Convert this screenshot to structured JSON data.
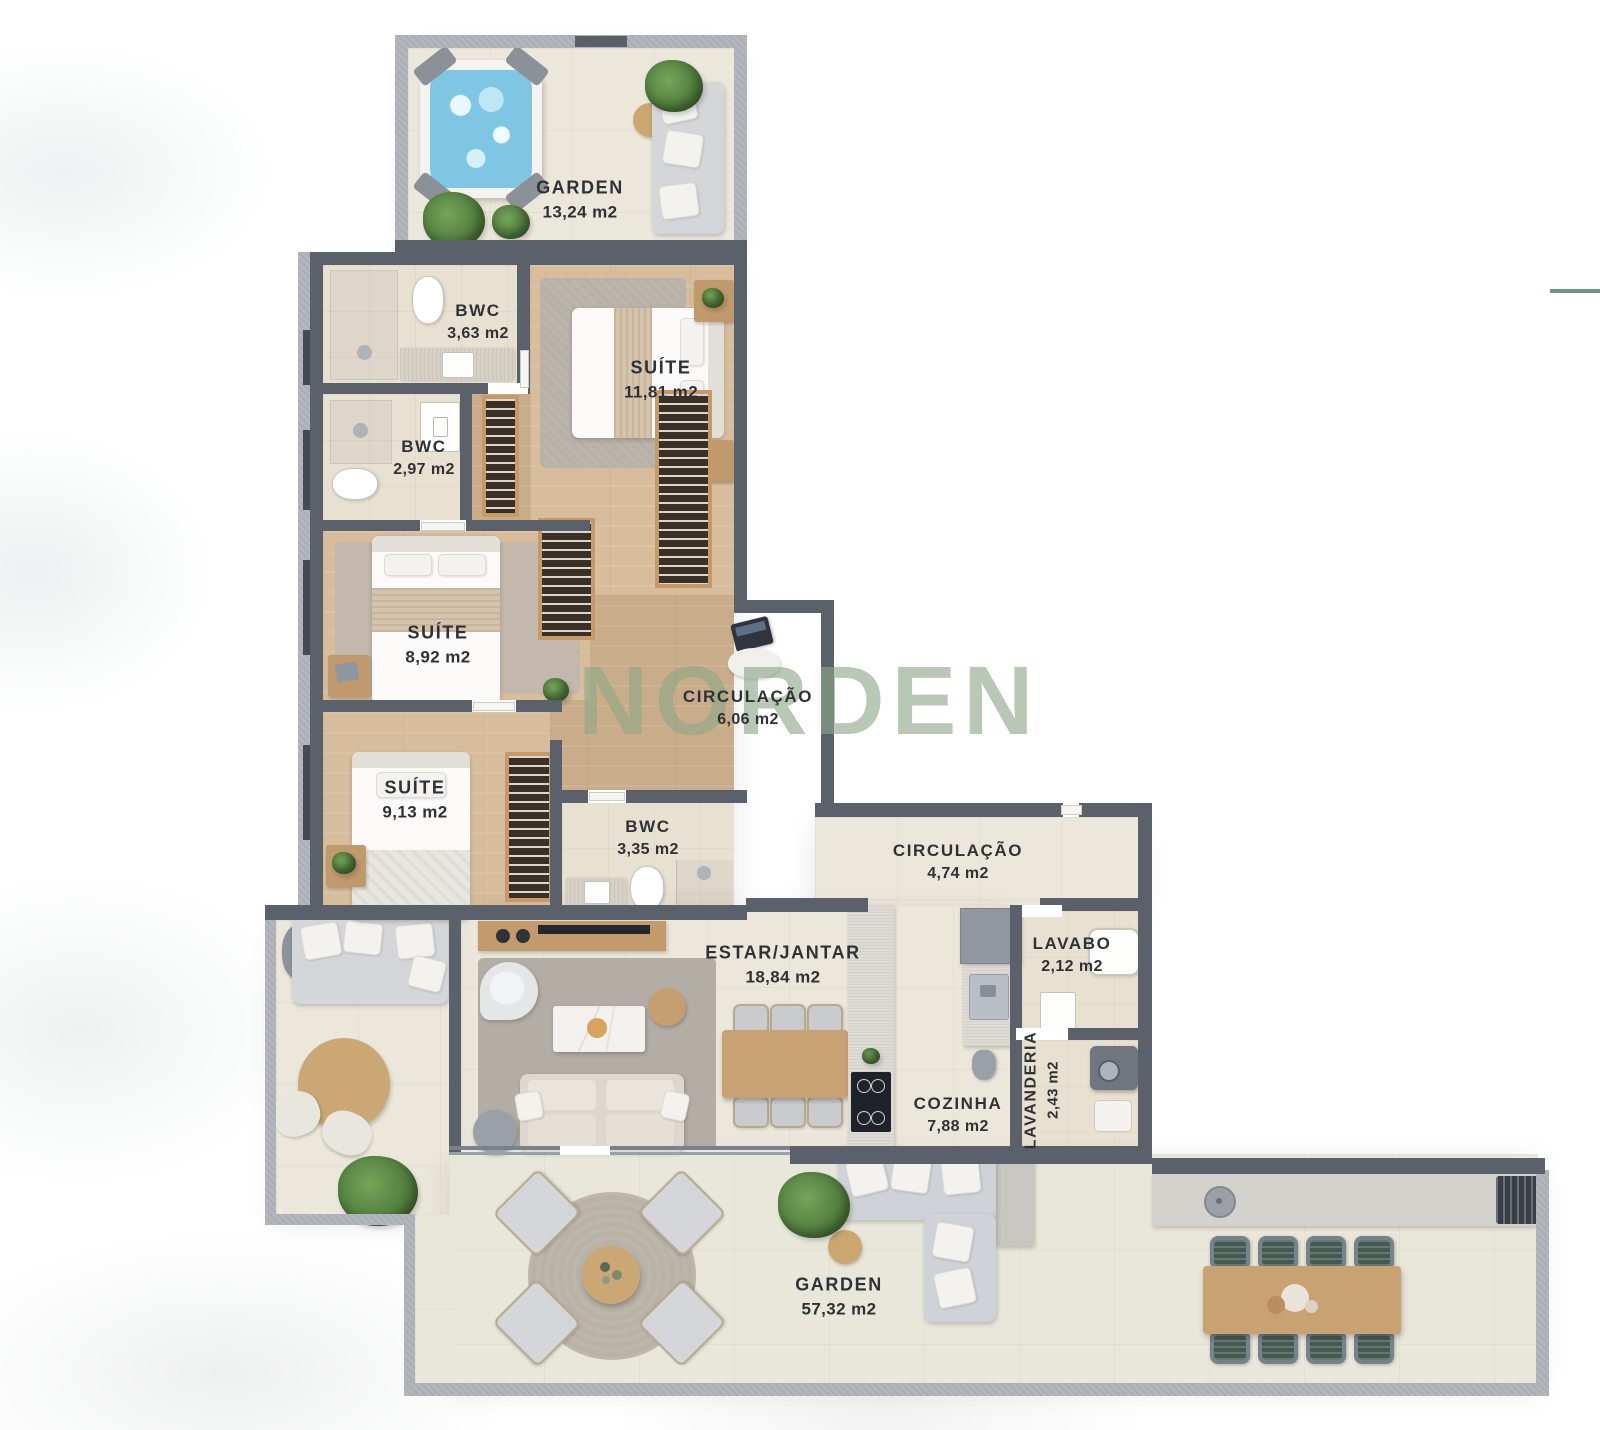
{
  "watermark": "NORDEN",
  "accent_line_color": "#74908c",
  "colors": {
    "wall_dark": "#5a616b",
    "wall_light": "#b3b7bd",
    "wood_floor": "#c9ad8a",
    "tile_floor": "#ece7db",
    "water_blue": "#7fc6e4",
    "watermark_green": "#8ea788"
  },
  "rooms": [
    {
      "id": "garden-rooftop",
      "name": "GARDEN",
      "area": "13,24 m2"
    },
    {
      "id": "bwc-1",
      "name": "BWC",
      "area": "3,63 m2"
    },
    {
      "id": "suite-1",
      "name": "SUÍTE",
      "area": "11,81 m2"
    },
    {
      "id": "bwc-2",
      "name": "BWC",
      "area": "2,97 m2"
    },
    {
      "id": "suite-2",
      "name": "SUÍTE",
      "area": "8,92 m2"
    },
    {
      "id": "circulacao-1",
      "name": "CIRCULAÇÃO",
      "area": "6,06 m2"
    },
    {
      "id": "suite-3",
      "name": "SUÍTE",
      "area": "9,13 m2"
    },
    {
      "id": "bwc-3",
      "name": "BWC",
      "area": "3,35 m2"
    },
    {
      "id": "circulacao-2",
      "name": "CIRCULAÇÃO",
      "area": "4,74 m2"
    },
    {
      "id": "estar-jantar",
      "name": "ESTAR/JANTAR",
      "area": "18,84 m2"
    },
    {
      "id": "lavabo",
      "name": "LAVABO",
      "area": "2,12 m2"
    },
    {
      "id": "cozinha",
      "name": "COZINHA",
      "area": "7,88 m2"
    },
    {
      "id": "lavanderia",
      "name": "LAVANDERIA",
      "area": "2,43 m2"
    },
    {
      "id": "garden-main",
      "name": "GARDEN",
      "area": "57,32 m2"
    }
  ]
}
